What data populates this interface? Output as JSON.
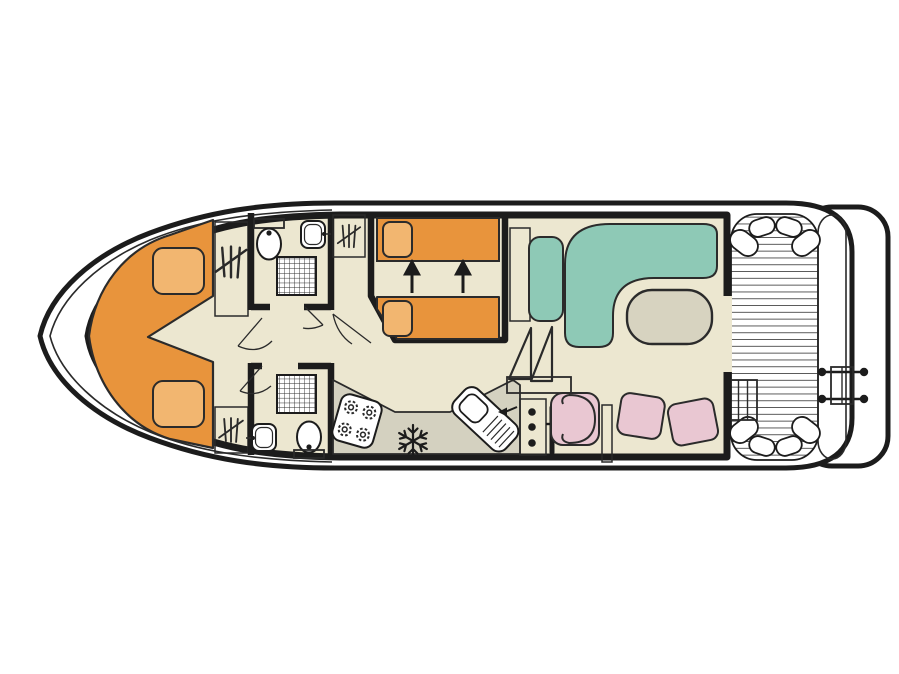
{
  "image_type": "boat-deck-floor-plan",
  "theme": {
    "hull_outline": "#1c1c1c",
    "interior_floor": "#ece7d0",
    "furniture_gray": "#d4d1c0",
    "wardrobe_gray": "#cfccbc",
    "bed_orange": "#e8943c",
    "pillow_orange": "#f2b670",
    "sofa_teal": "#8ec9b6",
    "seat_pink": "#e9c7d2",
    "table_gray": "#d7d3c0",
    "deck_white": "#ffffff",
    "thin_line": "#2a2a2a"
  },
  "plan": {
    "orientation": "bow-left-stern-right",
    "sections": [
      {
        "name": "bow-cabin",
        "features": [
          "v-shaped-double-berth",
          "pillow-port",
          "pillow-starboard",
          "wardrobe-port",
          "wardrobe-starboard"
        ]
      },
      {
        "name": "bathroom-fore-port",
        "features": [
          "toilet-with-cistern",
          "washbasin",
          "shower-grid"
        ]
      },
      {
        "name": "bathroom-fore-starboard",
        "features": [
          "toilet-with-cistern",
          "washbasin",
          "shower-grid"
        ]
      },
      {
        "name": "guest-cabin-midship",
        "features": [
          "single-berth-upper",
          "single-berth-lower",
          "slide-together-arrows",
          "wardrobe"
        ],
        "arrow_count": 2
      },
      {
        "name": "galley",
        "features": [
          "angled-counter",
          "hob-4-burners",
          "fridge-freezer-snowflake",
          "sink-with-drainboard-and-tap-arrow"
        ],
        "burner_count": 4
      },
      {
        "name": "helm",
        "features": [
          "instrument-console-3-dots",
          "throttle-lever",
          "grab-rail",
          "helm-swivel-seat",
          "stool-cushion-1",
          "stool-cushion-2"
        ],
        "console_dot_count": 3
      },
      {
        "name": "salon",
        "features": [
          "sideboard",
          "side-seat",
          "l-shaped-sofa",
          "oval-table",
          "companionway-step-triangles",
          "step-platform"
        ]
      },
      {
        "name": "aft-deck",
        "features": [
          "teak-plank-floor",
          "entry-steps-3-treads",
          "corner-cushions-x4",
          "transom-band",
          "swim-ladder-4-lugs",
          "swim-platform"
        ]
      }
    ]
  }
}
